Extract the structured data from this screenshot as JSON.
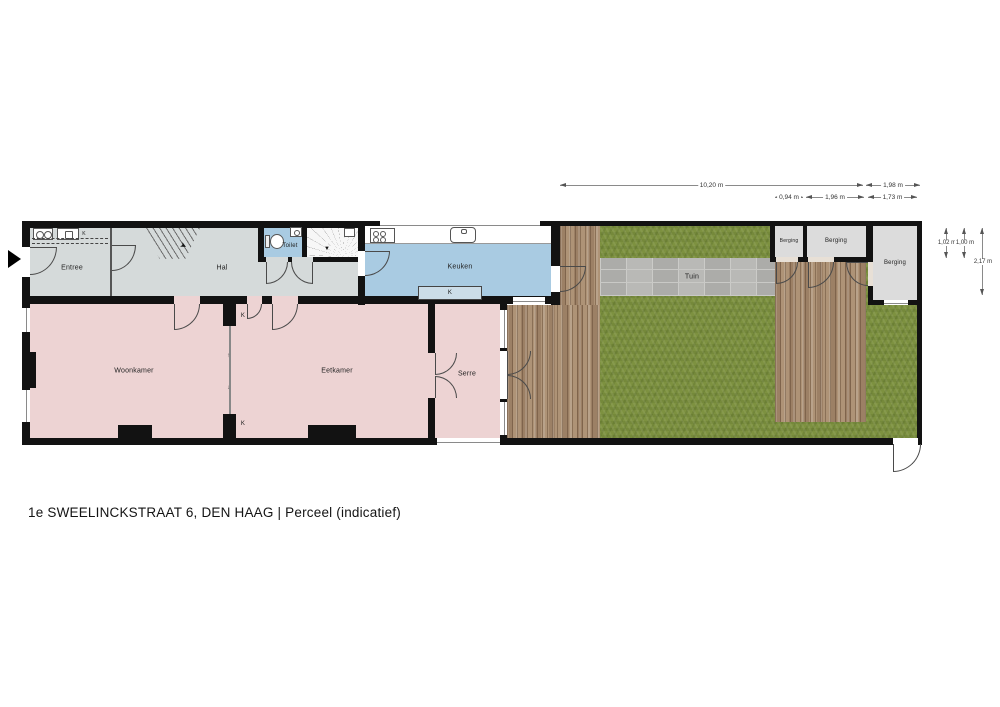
{
  "title": "1e SWEELINCKSTRAAT 6, DEN HAAG | Perceel (indicatief)",
  "rooms": {
    "entree": "Entree",
    "hal": "Hal",
    "toilet": "Toilet",
    "keuken": "Keuken",
    "woonkamer": "Woonkamer",
    "eetkamer": "Eetkamer",
    "serre": "Serre",
    "tuin": "Tuin",
    "berging_left": "Berging",
    "berging_middle": "Berging",
    "berging_right": "Berging"
  },
  "closets": [
    "K",
    "K",
    "K",
    "K"
  ],
  "dimensions": {
    "row1": [
      {
        "label": "10,20 m"
      },
      {
        "label": "1,98 m"
      }
    ],
    "row2": [
      {
        "label": "0,94 m"
      },
      {
        "label": "1,96 m"
      },
      {
        "label": "1,73 m"
      }
    ],
    "vertical": [
      {
        "label": "1,02 m"
      },
      {
        "label": "1,00 m"
      },
      {
        "label": "2,17 m"
      }
    ]
  },
  "colors": {
    "wall": "#121212",
    "hallway_floor": "#d5dada",
    "living_floor": "#edd3d3",
    "kitchen_floor": "#a9cbe2",
    "storage_floor": "#dcdcdc",
    "grass": "#7d9140",
    "deck_wood": "#a98e72",
    "garden_path": "#b5b5b2"
  }
}
